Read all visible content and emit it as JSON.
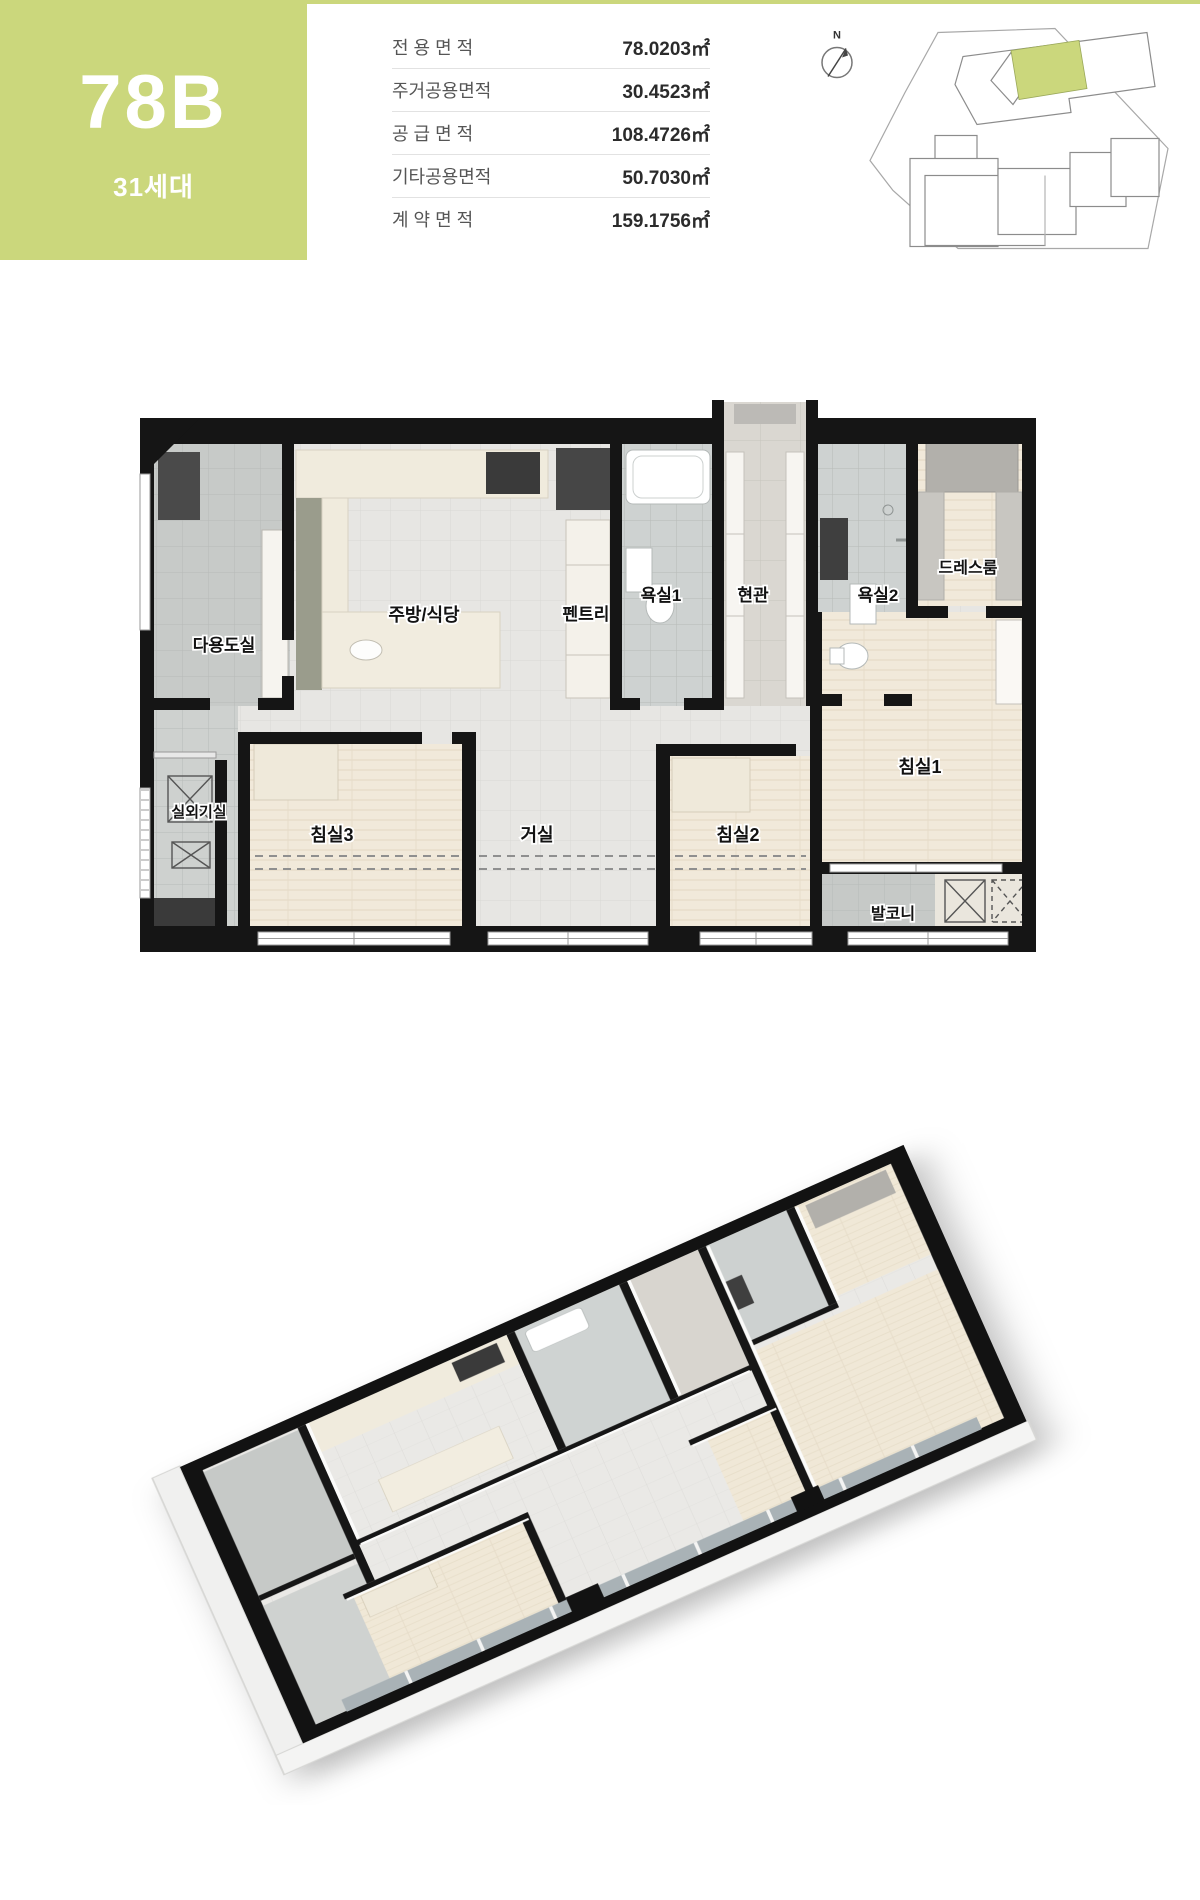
{
  "colors": {
    "accent_green": "#cbd77c",
    "wall_black": "#151515",
    "wood_floor": "#f1e9da",
    "tile_gray": "#e7e6e3",
    "utility_gray": "#c7cac8"
  },
  "header": {
    "unit_type": "78B",
    "household_count": "31세대"
  },
  "area_table": {
    "rows": [
      {
        "label": "전 용 면 적",
        "value": "78.0203㎡"
      },
      {
        "label": "주거공용면적",
        "value": "30.4523㎡"
      },
      {
        "label": "공 급 면 적",
        "value": "108.4726㎡"
      },
      {
        "label": "기타공용면적",
        "value": "50.7030㎡"
      },
      {
        "label": "계 약 면 적",
        "value": "159.1756㎡"
      }
    ]
  },
  "key_plan": {
    "compass_label": "N",
    "highlight_color": "#cbd77c"
  },
  "floor_plan": {
    "rooms": [
      {
        "id": "utility",
        "label": "다용도실",
        "x": 224,
        "y": 651,
        "size": 17
      },
      {
        "id": "kitchen",
        "label": "주방/식당",
        "x": 424,
        "y": 621,
        "size": 18
      },
      {
        "id": "pantry",
        "label": "펜트리",
        "x": 586,
        "y": 620,
        "size": 17
      },
      {
        "id": "bath1",
        "label": "욕실1",
        "x": 661,
        "y": 601,
        "size": 17
      },
      {
        "id": "entrance",
        "label": "현관",
        "x": 753,
        "y": 601,
        "size": 17
      },
      {
        "id": "bath2",
        "label": "욕실2",
        "x": 878,
        "y": 601,
        "size": 17
      },
      {
        "id": "dressroom",
        "label": "드레스룸",
        "x": 968,
        "y": 573,
        "size": 16
      },
      {
        "id": "ac-room",
        "label": "실외기실",
        "x": 199,
        "y": 817,
        "size": 15
      },
      {
        "id": "bedroom3",
        "label": "침실3",
        "x": 332,
        "y": 841,
        "size": 18
      },
      {
        "id": "living",
        "label": "거실",
        "x": 537,
        "y": 841,
        "size": 18
      },
      {
        "id": "bedroom2",
        "label": "침실2",
        "x": 738,
        "y": 841,
        "size": 18
      },
      {
        "id": "bedroom1",
        "label": "침실1",
        "x": 920,
        "y": 773,
        "size": 18
      },
      {
        "id": "balcony",
        "label": "발코니",
        "x": 893,
        "y": 919,
        "size": 16
      }
    ]
  }
}
